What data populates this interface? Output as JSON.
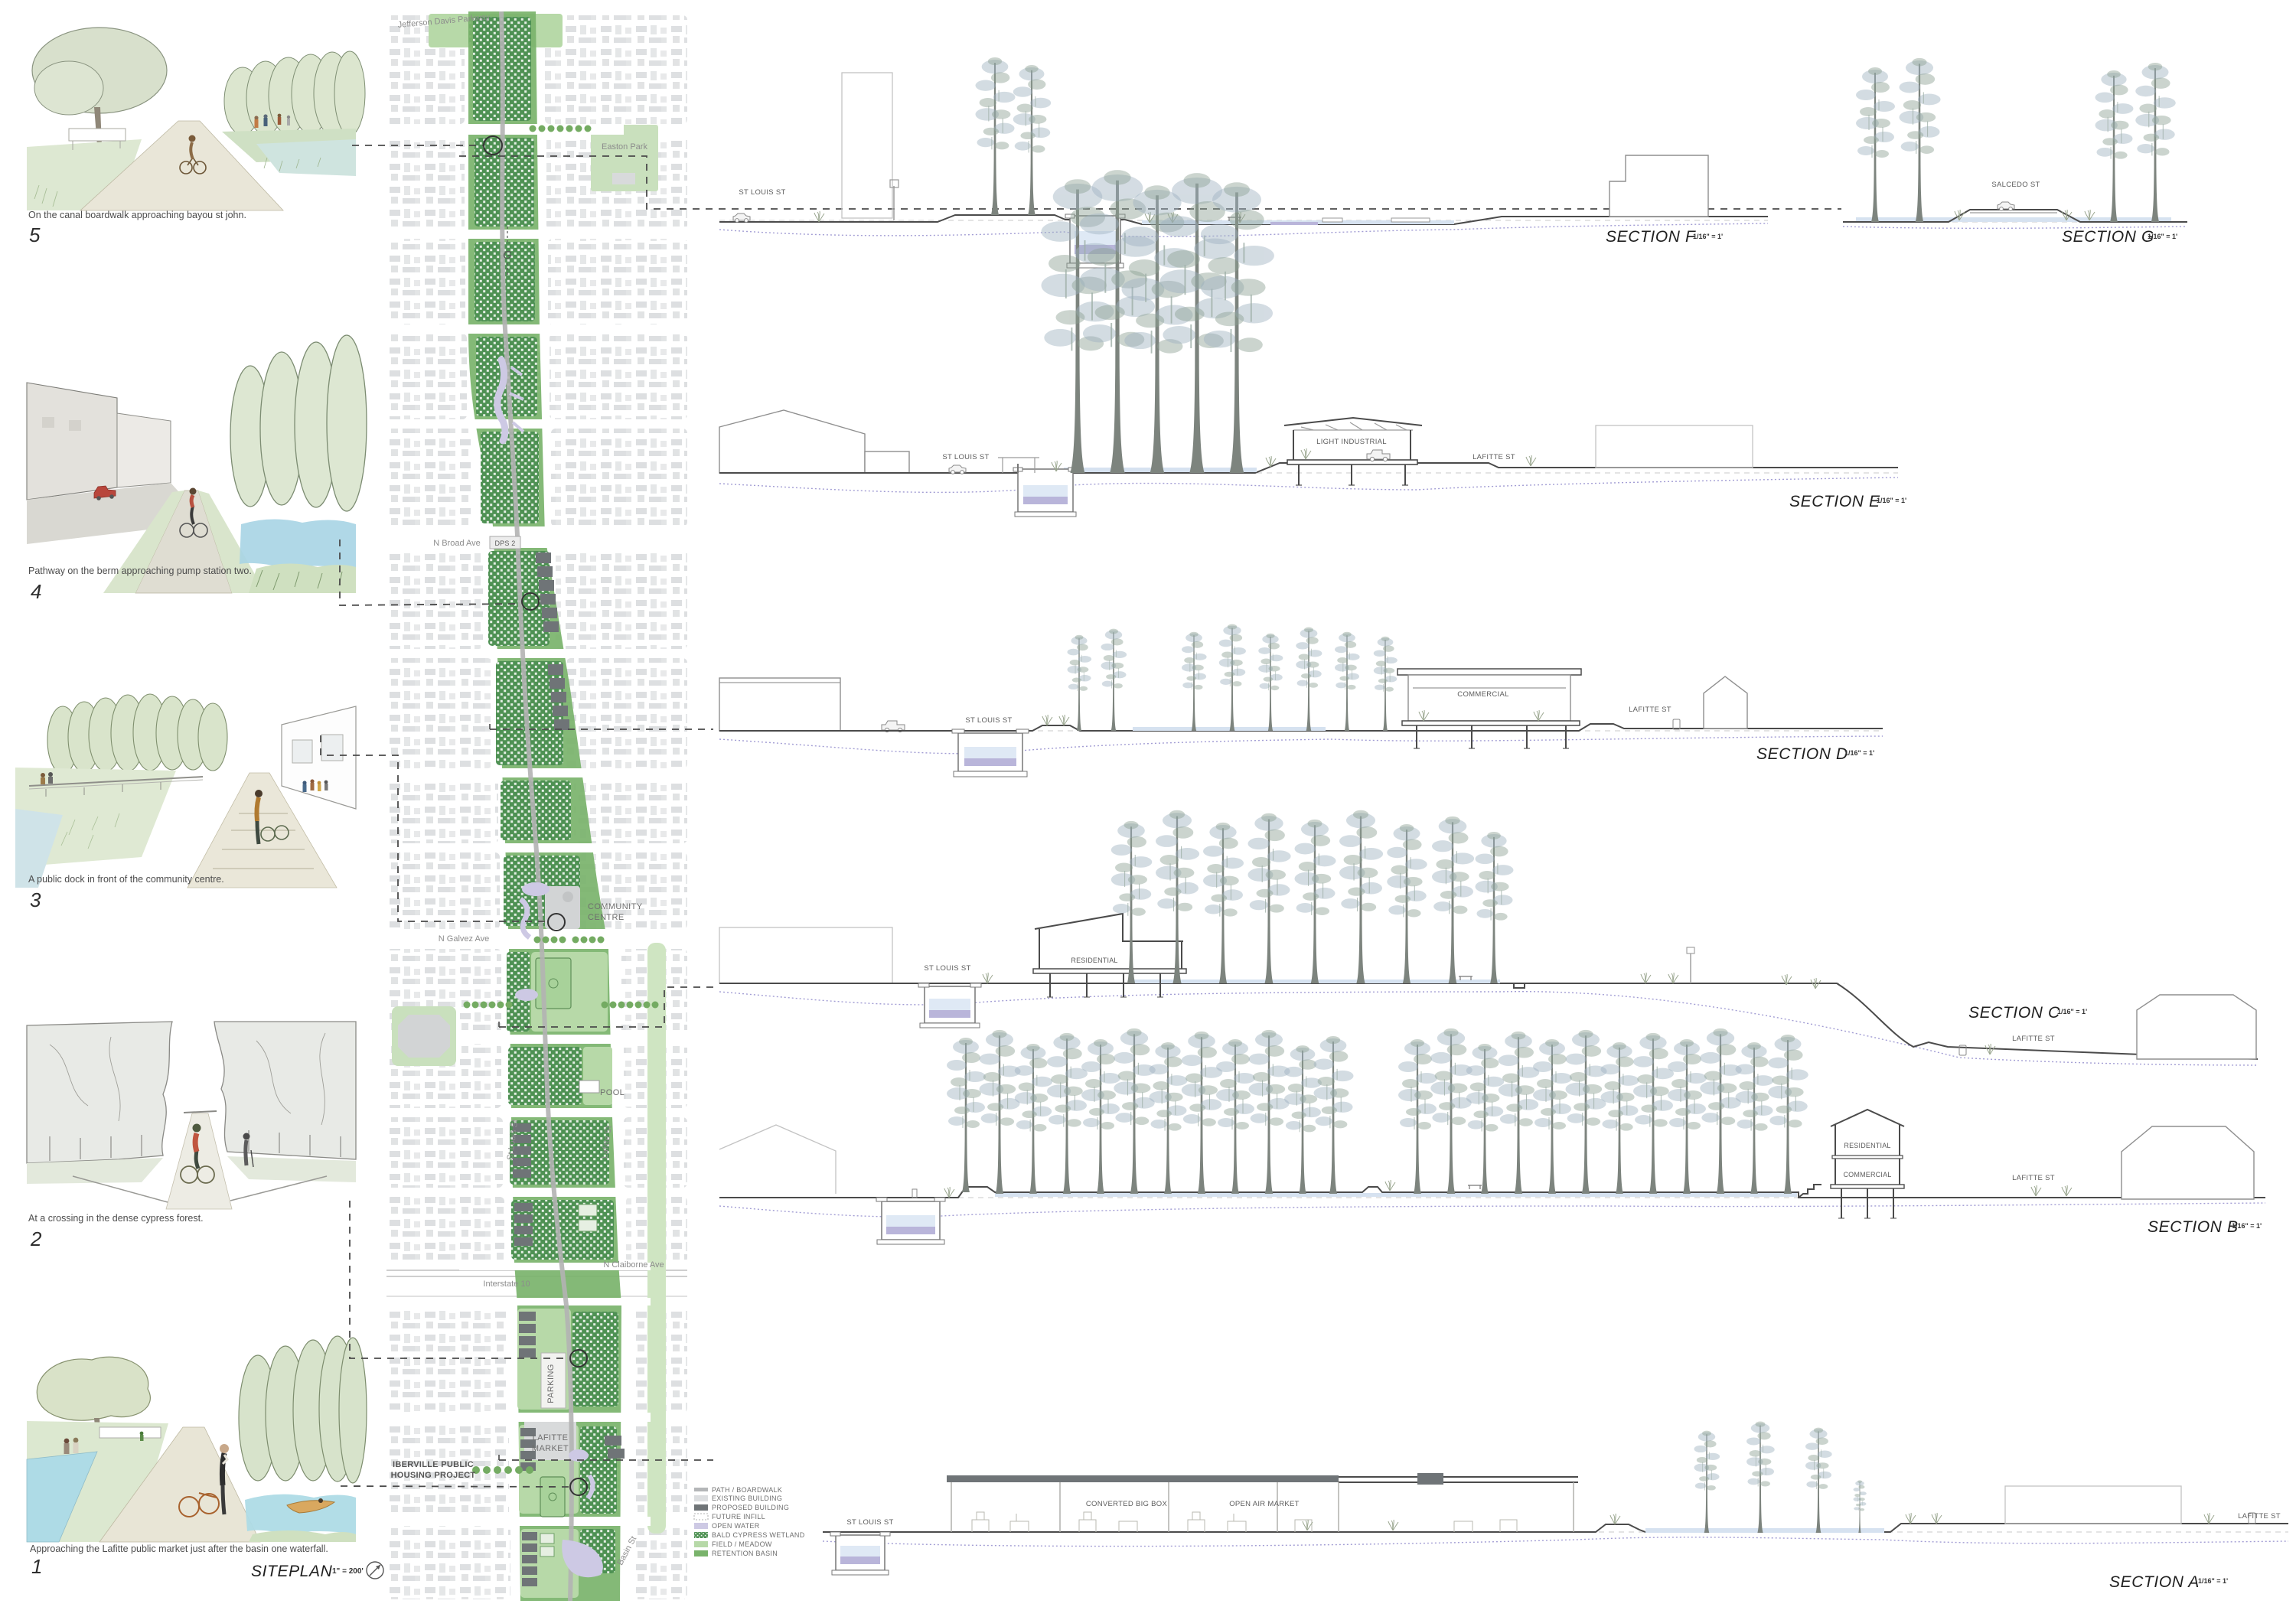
{
  "siteplan": {
    "title": "SITEPLAN",
    "scale_note": "1\" = 200'",
    "section_marker": "G",
    "streets": {
      "jefferson_davis": "Jefferson Davis Parkway",
      "n_broad": "N Broad Ave",
      "n_galvez": "N Galvez Ave",
      "interstate": "Interstate 10",
      "n_claiborne": "N Claiborne Ave",
      "st_louis": "St Louis St",
      "lafitte": "Lafitte St",
      "basin": "Basin St"
    },
    "places": {
      "easton_park": "Easton Park",
      "dps2": "DPS 2",
      "community_1": "COMMUNITY",
      "community_2": "CENTRE",
      "pool": "POOL",
      "parking": "PARKING",
      "market_1": "LAFITTE",
      "market_2": "MARKET",
      "iberville_1": "IBERVILLE PUBLIC",
      "iberville_2": "HOUSING PROJECT"
    }
  },
  "vignettes": [
    {
      "number": "5",
      "caption": "On the canal boardwalk approaching bayou st john."
    },
    {
      "number": "4",
      "caption": "Pathway on the berm approaching pump station two."
    },
    {
      "number": "3",
      "caption": "A public dock in front of the community centre."
    },
    {
      "number": "2",
      "caption": "At a crossing in the dense cypress forest."
    },
    {
      "number": "1",
      "caption": "Approaching the Lafitte public market just after the basin one waterfall."
    }
  ],
  "sections": {
    "f": {
      "title": "SECTION F",
      "scale": "1/16\" = 1'",
      "street_left": "ST LOUIS ST"
    },
    "g": {
      "title": "SECTION G",
      "scale": "1/16\" = 1'",
      "street": "SALCEDO ST"
    },
    "e": {
      "title": "SECTION E",
      "scale": "1/16\" = 1'",
      "street_left": "ST LOUIS ST",
      "building": "LIGHT INDUSTRIAL",
      "street_right": "LAFITTE ST"
    },
    "d": {
      "title": "SECTION D",
      "scale": "1/16\" = 1'",
      "street_left": "ST LOUIS ST",
      "building": "COMMERCIAL",
      "street_right": "LAFITTE ST"
    },
    "c": {
      "title": "SECTION C",
      "scale": "1/16\" = 1'",
      "street_left": "ST LOUIS ST",
      "building": "RESIDENTIAL",
      "street_right": "LAFITTE ST"
    },
    "b": {
      "title": "SECTION B",
      "scale": "1/16\" = 1'",
      "building_upper": "RESIDENTIAL",
      "building_lower": "COMMERCIAL",
      "street_right": "LAFITTE ST"
    },
    "a": {
      "title": "SECTION A",
      "scale": "1/16\" = 1'",
      "street_left": "ST LOUIS ST",
      "building_left": "CONVERTED BIG BOX",
      "building_right": "OPEN AIR MARKET",
      "street_right": "LAFITTE ST"
    }
  },
  "legend": {
    "items": [
      {
        "label": "PATH / BOARDWALK"
      },
      {
        "label": "EXISTING BUILDING"
      },
      {
        "label": "PROPOSED BUILDING"
      },
      {
        "label": "FUTURE INFILL"
      },
      {
        "label": "OPEN WATER"
      },
      {
        "label": "BALD CYPRESS WETLAND"
      },
      {
        "label": "FIELD / MEADOW"
      },
      {
        "label": "RETENTION BASIN"
      }
    ]
  },
  "colors": {
    "existing_building": "#dcdee0",
    "proposed_building": "#6f7477",
    "open_water": "#cdc9e4",
    "cypress_wetland": "#4e9153",
    "field_meadow": "#b7d9a8",
    "retention_basin": "#79b36b",
    "path_boardwalk": "#b4b6b8",
    "section_water": "#d6e2f0",
    "subsurface_water": "#a29dd4"
  }
}
